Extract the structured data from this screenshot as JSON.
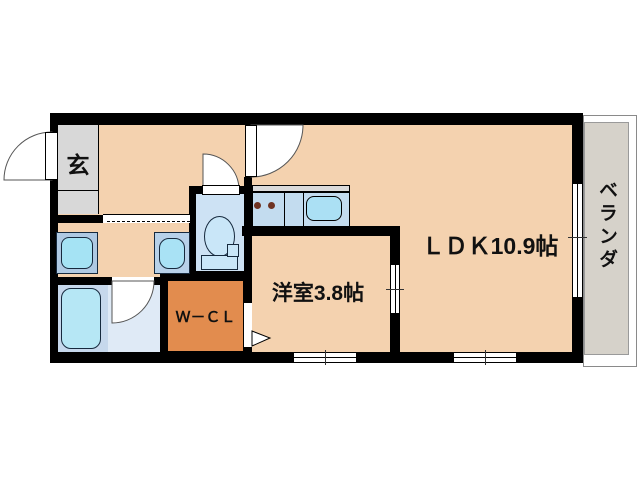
{
  "floorplan": {
    "type": "apartment-floorplan",
    "rooms": {
      "entrance": {
        "label": "玄"
      },
      "ldk": {
        "label": "ＬＤＫ10.9帖",
        "area_jo": 10.9
      },
      "western_room": {
        "label": "洋室3.8帖",
        "area_jo": 3.8
      },
      "walk_in_closet": {
        "label": "Ｗ－ＣＬ"
      },
      "veranda": {
        "label": "ベランダ"
      }
    },
    "fixtures": [
      "entrance-door",
      "ldk-door",
      "toilet",
      "toilet-door",
      "kitchen-counter",
      "stove-burners",
      "kitchen-sink",
      "washing-machine",
      "washbasin",
      "bathtub",
      "bathroom-door",
      "sliding-door-washroom",
      "sliding-door-western-room",
      "wcl-door",
      "window-western-room",
      "window-ldk",
      "window-veranda"
    ],
    "colors": {
      "wall": "#000000",
      "floor": "#F4D2AF",
      "entrance_tile": "#D8D8D8",
      "veranda": "#D6D2CA",
      "walk_in_closet": "#E28C4E",
      "bathroom_left": "#C6D8EC",
      "bathroom_right": "#DFEAF6",
      "toilet_room": "#CDE2F4",
      "kitchen_counter": "#C3DCEF",
      "kitchen_sink": "#ABE0F4",
      "bathtub": "#B6E7F5",
      "fixture_blue": "#A5E3F4",
      "burner": "#6F3322",
      "text": "#111111"
    }
  }
}
